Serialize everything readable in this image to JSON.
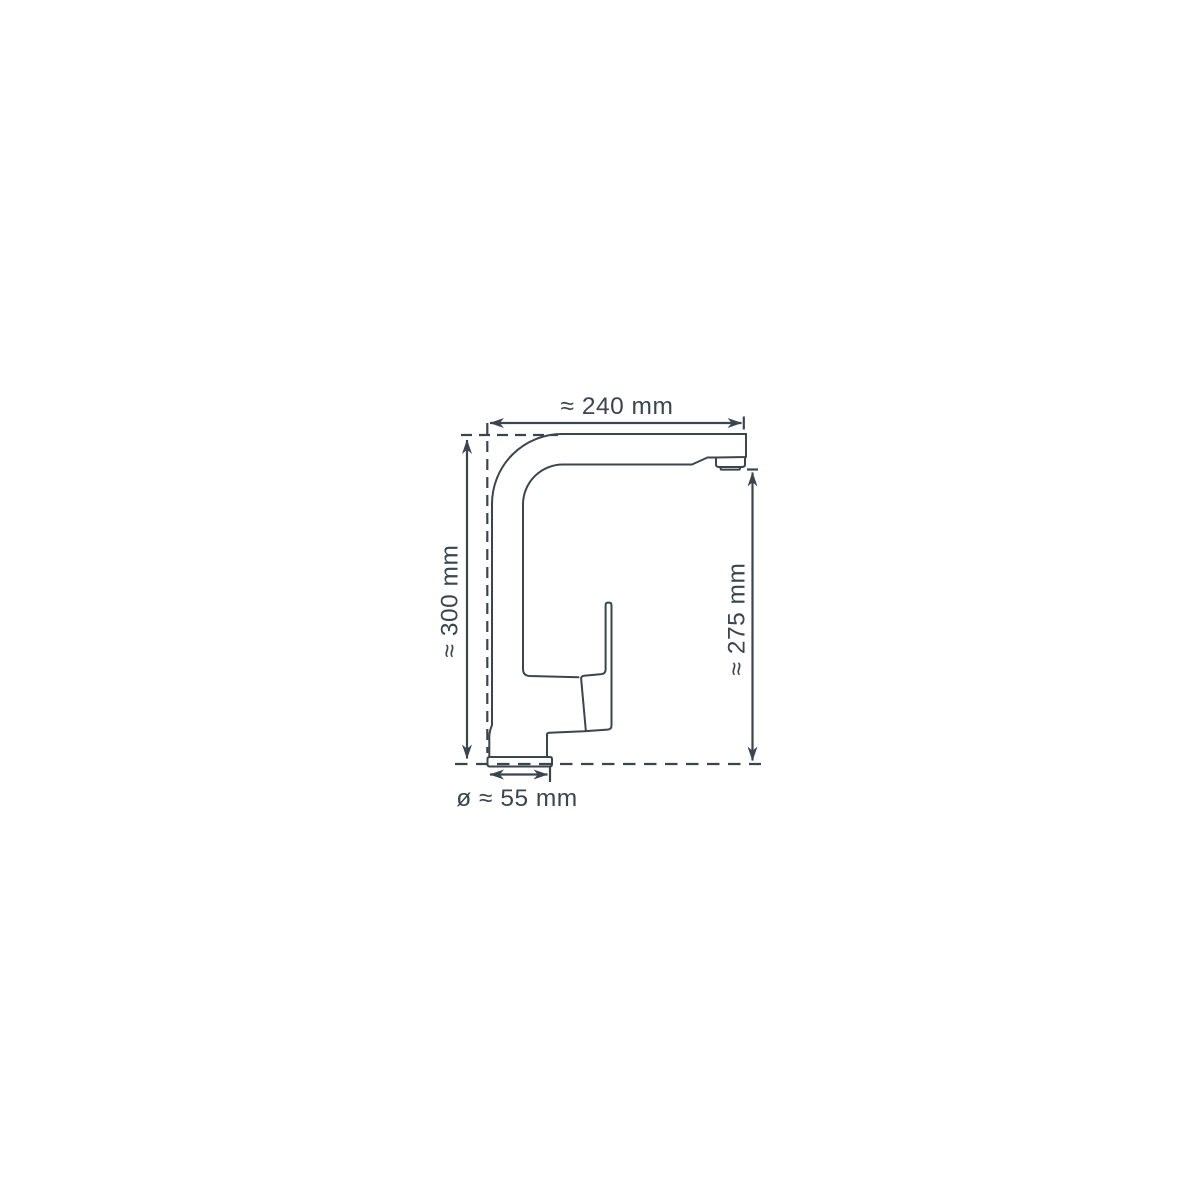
{
  "page": {
    "background_color": "#ffffff",
    "line_color": "#3b454f"
  },
  "diagram": {
    "subject": "faucet-side-view-dimension-drawing",
    "dimensions": {
      "spout_reach": {
        "label": "≈ 240 mm",
        "value_mm": 240
      },
      "total_height": {
        "label": "≈ 300 mm",
        "value_mm": 300
      },
      "spout_height": {
        "label": "≈ 275 mm",
        "value_mm": 275
      },
      "base_diameter": {
        "label": "ø ≈ 55 mm",
        "value_mm": 55
      }
    }
  }
}
